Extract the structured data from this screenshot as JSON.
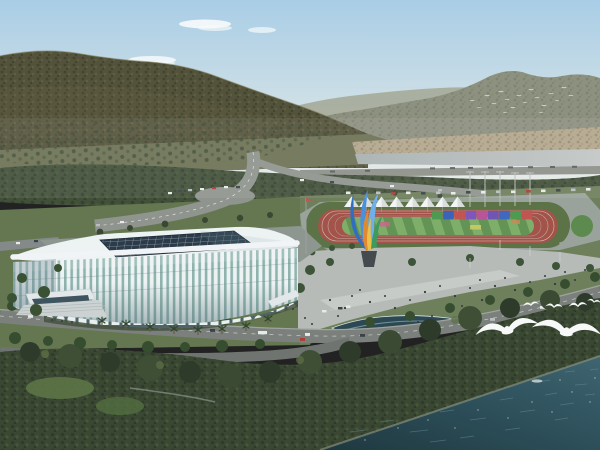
{
  "meta": {
    "title": "Stadium riverside aerial rendering",
    "description": "Aerial architectural rendering: white lattice-facade stadium with dark glass grid roof, athletics track with white canopy tents and rainbow billboard wall, colorful feather sculpture, plaza with visitors, tree-lined boulevards, forested mountains behind, and a river in front with flying white gulls."
  },
  "palette": {
    "sky_top": "#a9cde6",
    "sky_mid": "#cfe0e6",
    "sky_horizon": "#e3e9e6",
    "cloud": "#f7fafb",
    "ridge_far": "#a6ab99",
    "ridge_near": "#8d9180",
    "mountain": "#53523a",
    "mountain_dark": "#3c3f2b",
    "mountain_light": "#6d6949",
    "orchard": "#6d7355",
    "orchard_tree": "#3d4a33",
    "far_bank": "#b3a78c",
    "river": "#a8b0b0",
    "river_light": "#c2c6c5",
    "bank_road": "#8d9089",
    "tree_band": "#42503a",
    "tree_dark": "#2d3a28",
    "tree_mid": "#3a4833",
    "tree_light": "#55663f",
    "grass": "#647750",
    "grass_light": "#6f8755",
    "road": "#7b807c",
    "road_mid": "#8f948f",
    "road_dark": "#6f7470",
    "sidewalk": "#a8ada8",
    "plaza": "#b6bbb7",
    "plaza_path": "#c9cdc9",
    "apron": "#9aa39b",
    "stadium_white": "#edf2f3",
    "stadium_rim": "#f0f4f6",
    "facade_glass": "#8fb4ae",
    "facade_shade": "#48666c",
    "arcade_dark": "#4e6468",
    "roof_glass": "#2c3b49",
    "roof_grid": "#b9c6cd",
    "entrance_glass": "#3e5560",
    "track": "#a2544a",
    "lane_line": "#d8cfc6",
    "field_green_a": "#7fae6b",
    "field_green_b": "#639455",
    "tent": "#f3f5f5",
    "tent_shade": "#d9dedb",
    "wall_colors": [
      "#4f9a52",
      "#3a64b8",
      "#c05552",
      "#7e57bd",
      "#b8559a",
      "#6f56b5",
      "#3f68be",
      "#4f9a52",
      "#c05552"
    ],
    "sculpture_blue_1": "#2f6fc2",
    "sculpture_blue_2": "#4a90dc",
    "sculpture_blue_3": "#6fb0ea",
    "sculpture_orange": "#e08a30",
    "sculpture_yellow": "#ecc14a",
    "sculpture_green": "#3f9a5f",
    "pedestal": "#454a4e",
    "pool": "#2c4852",
    "water_deep": "#1f3840",
    "water_mid": "#2e515c",
    "water_light": "#3f6570",
    "ripple": "#6f94a0",
    "bird": "#f6f9f8",
    "bird_dark": "#3a4540",
    "people": "#343a40",
    "car_white": "#e8eaea",
    "car_dark": "#3a4148",
    "car_red": "#b03a34",
    "car_silver": "#b9bfc1"
  },
  "scene": {
    "sky": {
      "clouds": 4,
      "flock_birds": 18
    },
    "mountains": {
      "left": "forested ridge",
      "right_distant": "hazy range"
    },
    "midground": {
      "orchard_rows": true,
      "river_strip": true,
      "far_bank": true
    },
    "stadium": {
      "roof": "dark glass grid skylight",
      "facade": "white vertical fins over teal glass",
      "arcade_arches": 18,
      "entrance": "stair entrance with canopy"
    },
    "sports_park": {
      "tents": 8,
      "track": "red oval with striped infield",
      "billboard_panels": 9,
      "light_masts": 5
    },
    "sculpture": {
      "style": "feather flame",
      "colors": [
        "blue",
        "orange",
        "yellow",
        "green"
      ]
    },
    "plaza": {
      "visitors": 30,
      "fountain_pool": 1
    },
    "waterfront": {
      "large_gulls": 2,
      "small_gulls": 4,
      "dark_gulls": 2
    }
  }
}
